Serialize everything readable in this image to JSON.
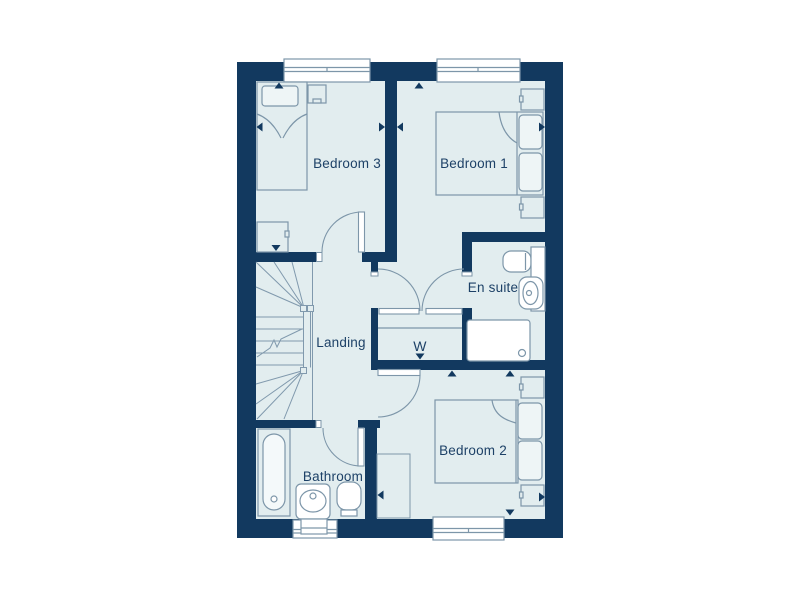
{
  "floorplan": {
    "rooms": {
      "bedroom3": {
        "label": "Bedroom 3"
      },
      "bedroom1": {
        "label": "Bedroom 1"
      },
      "ensuite": {
        "label": "En suite"
      },
      "landing": {
        "label": "Landing"
      },
      "wardrobe": {
        "label": "W"
      },
      "bathroom": {
        "label": "Bathroom"
      },
      "bedroom2": {
        "label": "Bedroom 2"
      }
    },
    "colors": {
      "wall": "#12395f",
      "floor": "#e2edef",
      "outline": "#7d96a9",
      "fixture": "#ffffff",
      "label": "#1d4167",
      "background": "#ffffff"
    }
  }
}
